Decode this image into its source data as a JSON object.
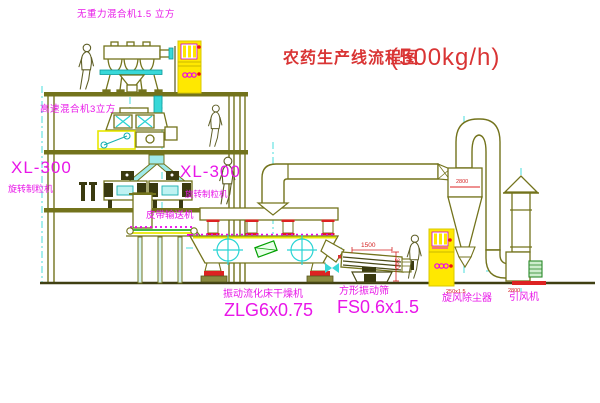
{
  "title": {
    "text": "农药生产线流程图",
    "capacity": "(500kg/h)"
  },
  "equipment_labels": {
    "top_mixer": "无重力混合机1.5 立方",
    "high_speed_mixer": "高速混合机3立方",
    "granulator_left": {
      "model": "XL-300",
      "name": "旋转制粒机"
    },
    "granulator_center": {
      "model": "XL-300",
      "name": "旋转制粒机"
    },
    "belt_conveyor": "皮带输送机",
    "fluid_bed_dryer": {
      "name": "振动流化床干燥机",
      "model": "ZLG6x0.75"
    },
    "vibrating_screen": {
      "name": "方形振动筛",
      "model": "FS0.6x1.5"
    },
    "cyclone": "旋风除尘器",
    "induced_draft_fan": "引风机"
  },
  "dimensions": {
    "screen_length": "1500",
    "screen_drop": "340",
    "cyclone_width": "2800",
    "note_cyclone_outlet": "250x1.5",
    "note_stack": "2800"
  },
  "colors": {
    "line_olive": "#73731c",
    "accent_cyan": "#38d8d8",
    "label_magenta": "#e816e8",
    "title_red": "#d93434",
    "cabinet_yellow": "#ffe800",
    "belt_green": "#00a000",
    "pad_red": "#dd2222"
  }
}
